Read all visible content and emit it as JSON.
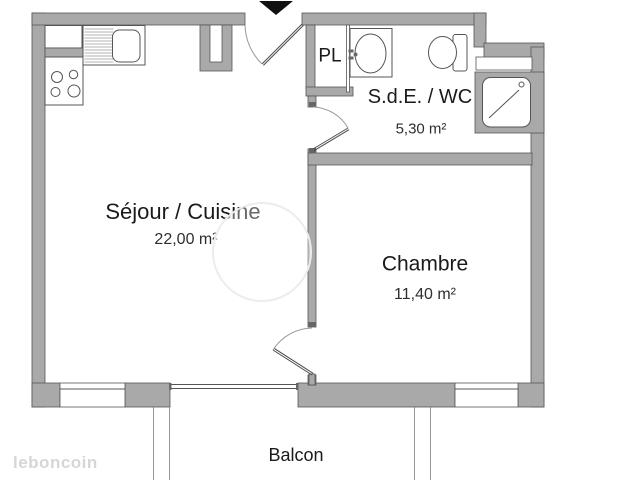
{
  "labels": {
    "sejour": {
      "title": "Séjour / Cuisine",
      "area": "22,00 m²"
    },
    "chambre": {
      "title": "Chambre",
      "area": "11,40 m²"
    },
    "sde": {
      "title": "S.d.E. / WC",
      "area": "5,30 m²"
    },
    "pl": {
      "title": "PL"
    },
    "balcon": {
      "title": "Balcon"
    }
  },
  "watermark": {
    "brand": "leboncoin"
  },
  "colors": {
    "wall": "#a9a9a9",
    "edge": "#555555",
    "text": "#1a1a1a",
    "watermark": "#d6d6d6",
    "background": "#ffffff"
  }
}
